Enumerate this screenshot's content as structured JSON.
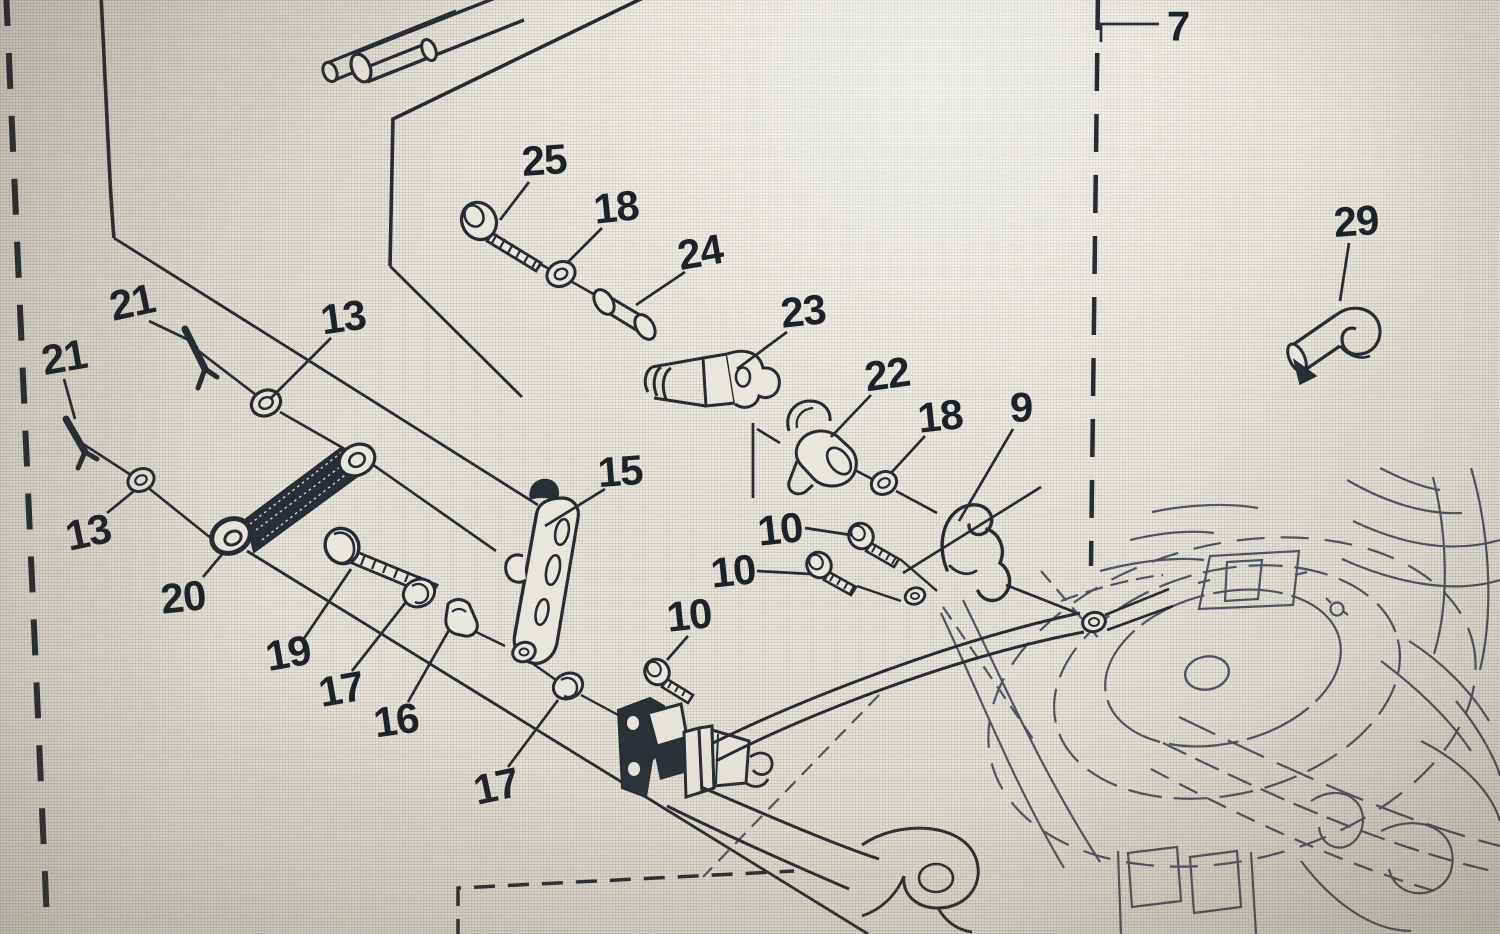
{
  "figure": {
    "kind": "exploded-parts-diagram",
    "description": "Monochrome line-art exploded view of a control linkage mounted to an engine, photographed from a screen",
    "part_numbers_shown": [
      "7",
      "9",
      "10",
      "13",
      "15",
      "16",
      "17",
      "18",
      "19",
      "20",
      "21",
      "22",
      "23",
      "24",
      "25",
      "29"
    ]
  },
  "colors": {
    "ink": "#272c35",
    "ink_light": "#4d5464",
    "paper": "#e9e6dd",
    "label_text": "#1d222b"
  },
  "callouts": [
    {
      "label": "7",
      "tx": 1178,
      "ty": 26,
      "rot": 0,
      "leader": [
        [
          1159,
          24
        ],
        [
          1101,
          24
        ],
        [
          1101,
          42
        ]
      ]
    },
    {
      "label": "21",
      "tx": 132,
      "ty": 302,
      "rot": -12,
      "leader": [
        [
          149,
          321
        ],
        [
          193,
          342
        ]
      ]
    },
    {
      "label": "13",
      "tx": 343,
      "ty": 317,
      "rot": -8,
      "leader": [
        [
          331,
          338
        ],
        [
          271,
          398
        ]
      ]
    },
    {
      "label": "21",
      "tx": 64,
      "ty": 357,
      "rot": -10,
      "leader": [
        [
          64,
          379
        ],
        [
          75,
          419
        ]
      ]
    },
    {
      "label": "13",
      "tx": 88,
      "ty": 532,
      "rot": -12,
      "leader": [
        [
          107,
          513
        ],
        [
          134,
          491
        ]
      ]
    },
    {
      "label": "20",
      "tx": 183,
      "ty": 597,
      "rot": -6,
      "leader": [
        [
          203,
          577
        ],
        [
          224,
          552
        ]
      ]
    },
    {
      "label": "19",
      "tx": 288,
      "ty": 653,
      "rot": -10,
      "leader": [
        [
          303,
          640
        ],
        [
          351,
          569
        ]
      ]
    },
    {
      "label": "17",
      "tx": 341,
      "ty": 689,
      "rot": -10,
      "leader": [
        [
          352,
          671
        ],
        [
          406,
          602
        ]
      ]
    },
    {
      "label": "16",
      "tx": 396,
      "ty": 720,
      "rot": -8,
      "leader": [
        [
          408,
          702
        ],
        [
          449,
          630
        ]
      ]
    },
    {
      "label": "17",
      "tx": 496,
      "ty": 786,
      "rot": -12,
      "leader": [
        [
          508,
          767
        ],
        [
          558,
          700
        ]
      ]
    },
    {
      "label": "25",
      "tx": 544,
      "ty": 160,
      "rot": -4,
      "leader": [
        [
          529,
          182
        ],
        [
          500,
          220
        ]
      ]
    },
    {
      "label": "18",
      "tx": 616,
      "ty": 207,
      "rot": -6,
      "leader": [
        [
          602,
          228
        ],
        [
          568,
          262
        ]
      ]
    },
    {
      "label": "24",
      "tx": 700,
      "ty": 252,
      "rot": -10,
      "leader": [
        [
          685,
          272
        ],
        [
          636,
          305
        ]
      ]
    },
    {
      "label": "23",
      "tx": 803,
      "ty": 311,
      "rot": -6,
      "leader": [
        [
          787,
          332
        ],
        [
          737,
          369
        ]
      ]
    },
    {
      "label": "22",
      "tx": 887,
      "ty": 374,
      "rot": -8,
      "leader": [
        [
          871,
          395
        ],
        [
          831,
          437
        ]
      ]
    },
    {
      "label": "18",
      "tx": 940,
      "ty": 416,
      "rot": -6,
      "leader": [
        [
          925,
          436
        ],
        [
          891,
          473
        ]
      ]
    },
    {
      "label": "9",
      "tx": 1021,
      "ty": 407,
      "rot": 0,
      "leader": [
        [
          1013,
          429
        ],
        [
          959,
          521
        ]
      ]
    },
    {
      "label": "10",
      "tx": 780,
      "ty": 529,
      "rot": -6,
      "leader": [
        [
          805,
          528
        ],
        [
          851,
          535
        ]
      ]
    },
    {
      "label": "10",
      "tx": 733,
      "ty": 571,
      "rot": -6,
      "leader": [
        [
          757,
          571
        ],
        [
          811,
          574
        ]
      ]
    },
    {
      "label": "10",
      "tx": 689,
      "ty": 615,
      "rot": -6,
      "leader": [
        [
          688,
          636
        ],
        [
          667,
          660
        ]
      ]
    },
    {
      "label": "15",
      "tx": 620,
      "ty": 471,
      "rot": -4,
      "leader": [
        [
          605,
          489
        ],
        [
          545,
          526
        ]
      ]
    },
    {
      "label": "29",
      "tx": 1356,
      "ty": 221,
      "rot": -4,
      "leader": [
        [
          1349,
          243
        ],
        [
          1340,
          301
        ]
      ]
    }
  ]
}
